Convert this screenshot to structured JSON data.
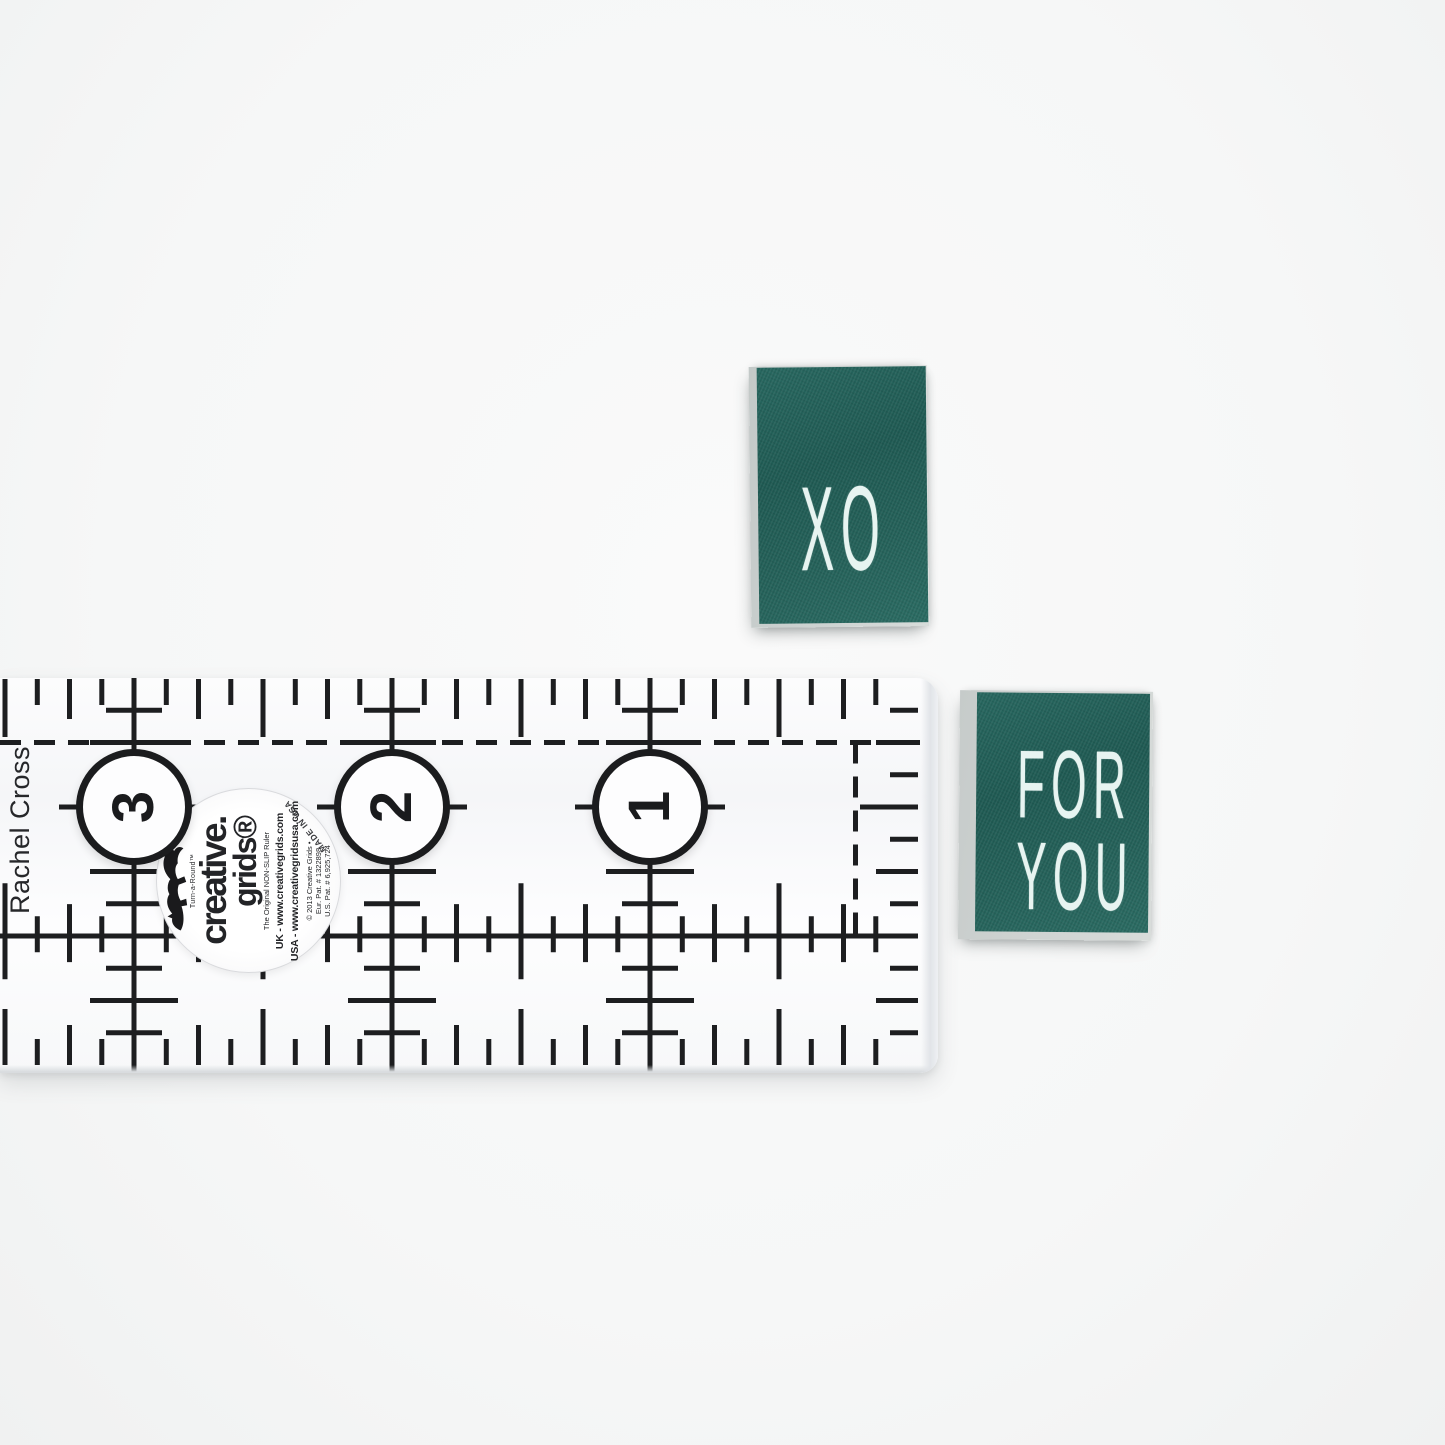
{
  "photo": {
    "background_color": "#f6f7f7"
  },
  "ruler": {
    "brand_name": "Rachel Cross",
    "ink_color": "#1d1e20",
    "numbers": [
      "3",
      "2",
      "1"
    ],
    "sticker": {
      "turnaround": "Turn-a-Round™",
      "brand_line1": "creative.",
      "brand_line2": "grids®",
      "tagline": "The Original NON-SLIP Ruler",
      "uk_line": "UK - www.creativegrids.com",
      "usa_line": "USA - www.creativegridsusa.com",
      "copyright_line": "© 2013 Creative Grids •",
      "patent_eu": "Eur. Pat. # 1322898",
      "patent_us": "U.S. Pat. # 6,925,724",
      "made_in": "MADE IN USA"
    }
  },
  "labels": {
    "fabric_color": "#235f58",
    "stitch_color": "#e7f4f1",
    "xo": {
      "text": "XO"
    },
    "for_you": {
      "line1": "FOR",
      "line2": "YOU"
    }
  }
}
